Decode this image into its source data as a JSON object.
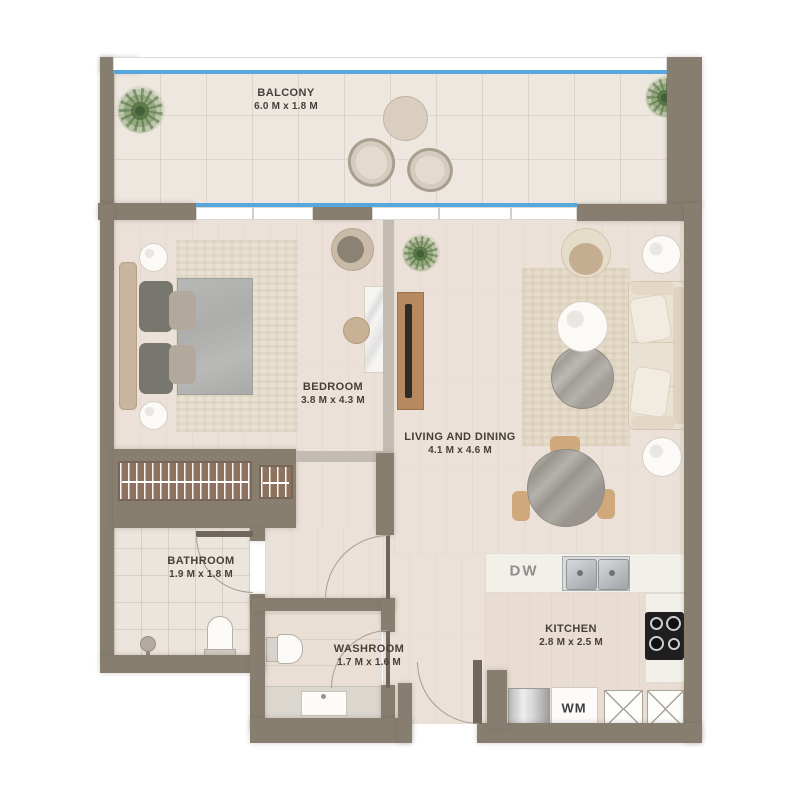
{
  "plan": {
    "rooms": {
      "balcony": {
        "name": "BALCONY",
        "dims": "6.0 M x 1.8 M"
      },
      "bedroom": {
        "name": "BEDROOM",
        "dims": "3.8 M x 4.3 M"
      },
      "living": {
        "name": "LIVING AND DINING",
        "dims": "4.1 M x 4.6 M"
      },
      "bathroom": {
        "name": "BATHROOM",
        "dims": "1.9 M x 1.8 M"
      },
      "washroom": {
        "name": "WASHROOM",
        "dims": "1.7 M x 1.6 M"
      },
      "kitchen": {
        "name": "KITCHEN",
        "dims": "2.8 M x 2.5 M"
      }
    },
    "appliances": {
      "dishwasher_label": "DW",
      "washer_label": "WM"
    },
    "colors": {
      "wall": "#877e6f",
      "glass": "#58a7dc",
      "wood_floor": "#ebe1d8",
      "furniture_wood": "#b68a5e",
      "greenery": "#6b8f57"
    }
  }
}
